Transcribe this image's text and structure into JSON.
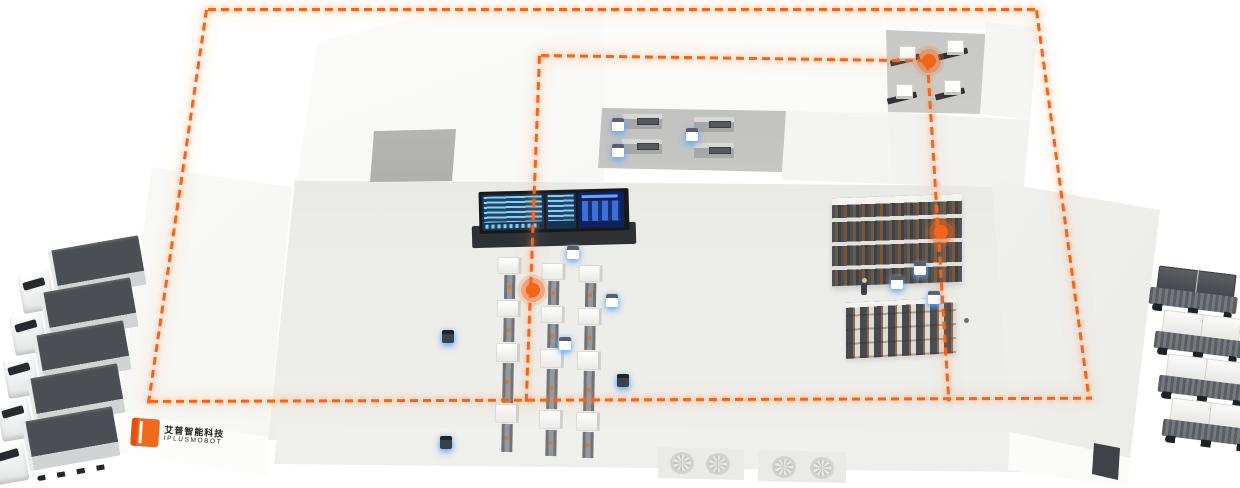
{
  "scene": {
    "description": "Isometric smart factory / logistics park with orange dashed AGV routes",
    "route_color": "#F2661C",
    "agv_glow_color": "#5AA8FF",
    "background_color": "#FFFFFF"
  },
  "brand": {
    "logo_cn": "艾普智能科技",
    "logo_en": "IPLUSMOBOT",
    "logo_color": "#F06A1E"
  },
  "fleet": {
    "delivery_trucks": 5,
    "cargo_shuttles": 4,
    "mobile_robots_white": 9,
    "mobile_robots_dark": 3,
    "workers": 2
  },
  "facility": {
    "production_lines": 3,
    "dock_stations": 4,
    "transfer_machines": 4,
    "storage_racks": 2,
    "route_nodes": 3,
    "vent_fans": 4,
    "control_wall_screens": 3
  }
}
